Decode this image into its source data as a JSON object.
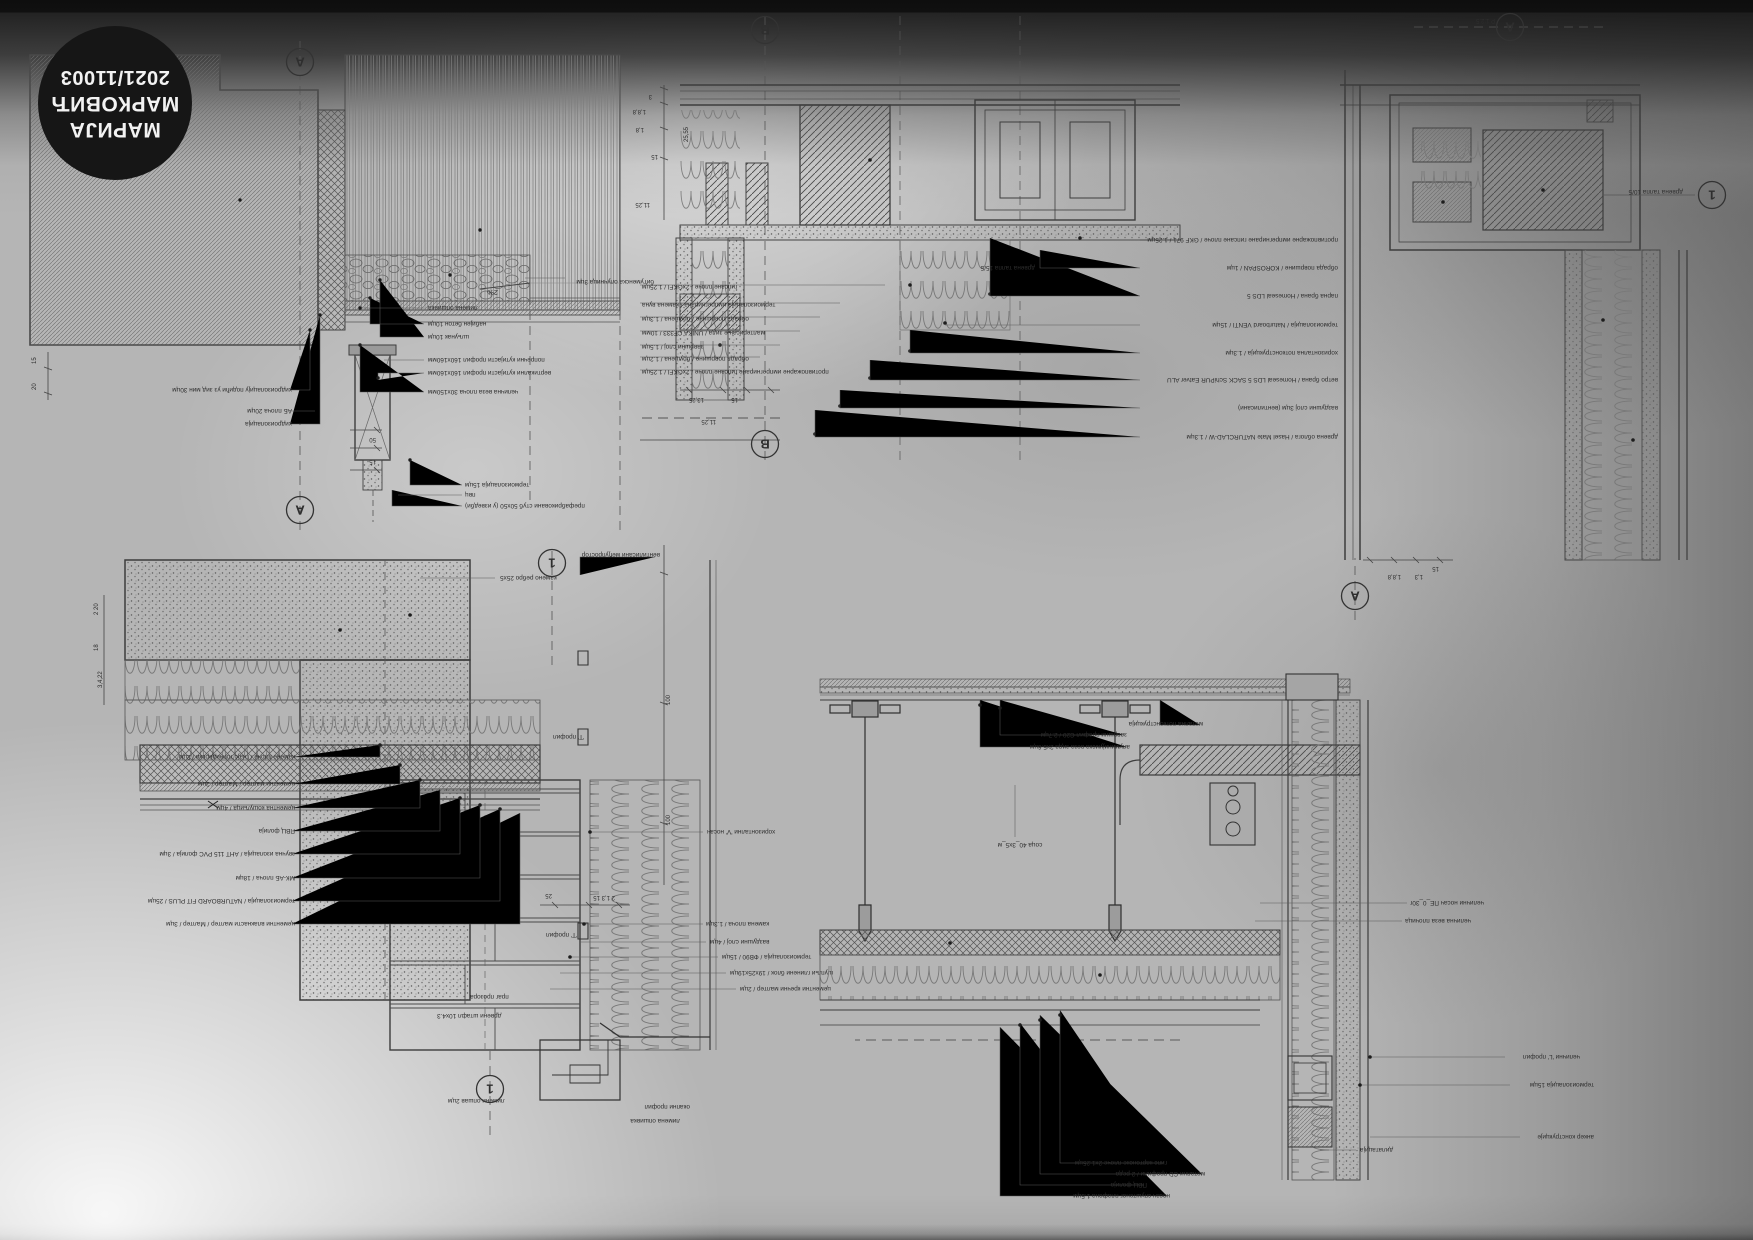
{
  "badge": {
    "line1": "МАРИЈА",
    "line2": "МАРКОВИЋ",
    "line3": "2021/11003"
  },
  "colors": {
    "paper": "#b5b5b5",
    "ink": "#3a3a3a",
    "badge_bg": "#161616",
    "badge_text": "#f2f2f2"
  },
  "details": {
    "terrace_edge": {
      "markers": [
        {
          "x": 360,
          "y": 20,
          "t": "A"
        },
        {
          "x": 360,
          "y": 468,
          "t": "A"
        }
      ],
      "labels": [
        {
          "x": 368,
          "y": 142,
          "t": "хидроизолацију подићи уз зид мин 30цм"
        },
        {
          "x": 368,
          "y": 121,
          "t": "АБ плоча 20цм"
        },
        {
          "x": 368,
          "y": 108,
          "t": "хидроизолација"
        },
        {
          "x": 232,
          "y": 224,
          "t": "лимена опшивка",
          "a": "e"
        },
        {
          "x": 232,
          "y": 208,
          "t": "набијен бетон 10цм",
          "a": "e"
        },
        {
          "x": 232,
          "y": 195,
          "t": "шљунак 10цм",
          "a": "e"
        },
        {
          "x": 232,
          "y": 172,
          "t": "попречни кутијасти профил 160x160мм",
          "a": "e"
        },
        {
          "x": 232,
          "y": 159,
          "t": "вертикални кутијасти профил 160x160мм",
          "a": "e"
        },
        {
          "x": 232,
          "y": 140,
          "t": "челична веза плоча 30x150мм",
          "a": "e"
        },
        {
          "x": 195,
          "y": 47,
          "t": "термоизолација 15цм",
          "a": "e"
        },
        {
          "x": 195,
          "y": 37,
          "t": "пвц",
          "a": "e"
        },
        {
          "x": 195,
          "y": 26,
          "t": "префабриковани стуб 50x50 (у изведби)",
          "a": "e"
        },
        {
          "x": 6,
          "y": 250,
          "t": "битуменска олучница 3цм"
        },
        {
          "x": 162,
          "y": 240,
          "t": "2%",
          "fs": 7.5
        },
        {
          "x": 284,
          "y": 70,
          "t": "15",
          "fs": 6
        },
        {
          "x": 284,
          "y": 92,
          "t": "50",
          "fs": 6
        },
        {
          "x": 624,
          "y": 140,
          "t": "20",
          "r": 90,
          "fs": 6
        },
        {
          "x": 624,
          "y": 166,
          "t": "15",
          "r": 90,
          "fs": 6
        }
      ]
    },
    "window_plan": {
      "markers": [
        {
          "x": 575,
          "y": 430,
          "t": "B"
        },
        {
          "x": 575,
          "y": 16,
          "t": "B"
        }
      ],
      "labels": [
        {
          "x": 2,
          "y": 222,
          "t": "противпожарне импрегниране гипсане плоче / GKF 971 / 1.25цм"
        },
        {
          "x": 2,
          "y": 194,
          "t": "обрада површине / KOROSPAN / 1цм"
        },
        {
          "x": 2,
          "y": 166,
          "t": "парна брана / Homeseal LDS 5"
        },
        {
          "x": 2,
          "y": 137,
          "t": "термоизолација / Naturboard VENTI / 15цм"
        },
        {
          "x": 2,
          "y": 109,
          "t": "хоризонтална потконструкција / 1.3цм"
        },
        {
          "x": 2,
          "y": 82,
          "t": "ветро брана / Homeseal LDS 5 SACK SchiPUR Eatver ALU"
        },
        {
          "x": 2,
          "y": 54,
          "t": "ваздушни слој 3цм (вентилисани)"
        },
        {
          "x": 2,
          "y": 25,
          "t": "дрвена облога / Hasel Mate NATURCLAD-W / 1.3цм"
        },
        {
          "x": 305,
          "y": 194,
          "t": "дрвена талпа 15/5"
        },
        {
          "x": 698,
          "y": 175,
          "t": "гипсане плоче / 2xGKFI / 1.25цм",
          "a": "e"
        },
        {
          "x": 698,
          "y": 157,
          "t": "термоизолација импрегнирана / камена вуна",
          "a": "e"
        },
        {
          "x": 698,
          "y": 143,
          "t": "обрада површине / брушена / 1.3цм",
          "a": "e"
        },
        {
          "x": 698,
          "y": 129,
          "t": "малтерисање зида / UNIKA CF333 / 10мм",
          "a": "e"
        },
        {
          "x": 698,
          "y": 115,
          "t": "завршни слој / 1.5цм",
          "a": "e"
        },
        {
          "x": 698,
          "y": 103,
          "t": "обрада површине / брушена / 1.2цм",
          "a": "e"
        },
        {
          "x": 698,
          "y": 90,
          "t": "противпожарне импрегниране гипсане плоче / 2xGKFI / 1.25цм",
          "a": "e"
        },
        {
          "x": 688,
          "y": 365,
          "t": "3",
          "fs": 6
        },
        {
          "x": 694,
          "y": 350,
          "t": "1,8,8",
          "fs": 6
        },
        {
          "x": 696,
          "y": 332,
          "t": "1,8",
          "fs": 6
        },
        {
          "x": 682,
          "y": 305,
          "t": "15",
          "fs": 6
        },
        {
          "x": 690,
          "y": 257,
          "t": "11,25",
          "fs": 6
        },
        {
          "x": 652,
          "y": 318,
          "t": "25,55",
          "r": 90,
          "fs": 6
        },
        {
          "x": 636,
          "y": 62,
          "t": "13,25",
          "fs": 6
        },
        {
          "x": 602,
          "y": 62,
          "t": "15",
          "fs": 6
        },
        {
          "x": 624,
          "y": 40,
          "t": "11,25",
          "fs": 6
        }
      ]
    },
    "corner_plan": {
      "markers": [
        {
          "x": 243,
          "y": 593,
          "t": "A"
        },
        {
          "x": 398,
          "y": 24,
          "t": "A"
        },
        {
          "x": 41,
          "y": 425,
          "t": "1"
        }
      ],
      "labels": [
        {
          "x": 258,
          "y": 601,
          "t": "Р 1:2.5",
          "fs": 6
        },
        {
          "x": 70,
          "y": 430,
          "t": "дрвена талпа 10/5"
        },
        {
          "x": 352,
          "y": 45,
          "t": "1,8,8",
          "fs": 6
        },
        {
          "x": 330,
          "y": 45,
          "t": "1,3",
          "fs": 6
        },
        {
          "x": 314,
          "y": 53,
          "t": "15",
          "fs": 6
        }
      ]
    },
    "corner_section": {
      "markers": [
        {
          "x": 288,
          "y": 572,
          "t": "1"
        },
        {
          "x": 350,
          "y": 46,
          "t": "1"
        }
      ],
      "labels": [
        {
          "x": 545,
          "y": 380,
          "t": "камене плоче / гнајс топчидерски / 2цм"
        },
        {
          "x": 545,
          "y": 353,
          "t": "цементни малтер / Малтер / 2цм"
        },
        {
          "x": 545,
          "y": 329,
          "t": "цементна кошуљица / 4цм"
        },
        {
          "x": 545,
          "y": 306,
          "t": "ПВЦ фолија"
        },
        {
          "x": 545,
          "y": 283,
          "t": "звучна изолација / АНТ 115 PVC фолија / 3цм"
        },
        {
          "x": 545,
          "y": 259,
          "t": "МК-АБ плоча / 18цм"
        },
        {
          "x": 545,
          "y": 236,
          "t": "термоизолација / NATURBOARD FIT PLUS / 25цм"
        },
        {
          "x": 545,
          "y": 213,
          "t": "цементни влакнасти малтер / Малтер / 3цм"
        },
        {
          "x": 133,
          "y": 305,
          "t": "хоризонтални 'V' носач",
          "a": "e"
        },
        {
          "x": 134,
          "y": 213,
          "t": "камена плоча / 1.3цм",
          "a": "e"
        },
        {
          "x": 130,
          "y": 195,
          "t": "ваздушни слој / 4цм",
          "a": "e"
        },
        {
          "x": 118,
          "y": 180,
          "t": "термоизолација / ФВ90 / 15цм",
          "a": "e"
        },
        {
          "x": 110,
          "y": 164,
          "t": "шупљи глинени блок / 19x25x19цм",
          "a": "e"
        },
        {
          "x": 100,
          "y": 148,
          "t": "цементни кречни малтер / 2цм",
          "a": "e"
        },
        {
          "x": 287,
          "y": 400,
          "t": "'Т' профил",
          "a": "e"
        },
        {
          "x": 294,
          "y": 202,
          "t": "'Т' профил",
          "a": "e"
        },
        {
          "x": 340,
          "y": 559,
          "t": "камено ребро 25x5",
          "a": "e"
        },
        {
          "x": 180,
          "y": 582,
          "t": "вентилисани међупростор"
        },
        {
          "x": 392,
          "y": 36,
          "t": "лимени опшав 2цм",
          "a": "e"
        },
        {
          "x": 150,
          "y": 30,
          "t": "окапни профил"
        },
        {
          "x": 160,
          "y": 16,
          "t": "лимена опшивка"
        },
        {
          "x": 370,
          "y": 140,
          "t": "праг прозора",
          "a": "e"
        },
        {
          "x": 403,
          "y": 121,
          "t": "дрвени штафл 10x4.3",
          "a": "e"
        },
        {
          "x": 170,
          "y": 310,
          "t": "100",
          "r": 90,
          "fs": 6
        },
        {
          "x": 170,
          "y": 430,
          "t": "100",
          "r": 90,
          "fs": 6
        },
        {
          "x": 288,
          "y": 241,
          "t": "25",
          "fs": 6
        },
        {
          "x": 225,
          "y": 239,
          "t": "2 1,3 15",
          "fs": 6
        },
        {
          "x": 742,
          "y": 520,
          "t": "2 20",
          "r": 90,
          "fs": 6
        },
        {
          "x": 742,
          "y": 484,
          "t": "18",
          "r": 90,
          "fs": 6
        },
        {
          "x": 738,
          "y": 447,
          "t": "3,4,22",
          "r": 90,
          "fs": 6
        }
      ]
    },
    "ceiling_section": {
      "markers": [],
      "labels": [
        {
          "x": 473,
          "y": 472,
          "t": "завршни профил C20 / 2.7цм"
        },
        {
          "x": 470,
          "y": 460,
          "t": "алуминијумска веза зида 2x5.6цм"
        },
        {
          "x": 397,
          "y": 483,
          "t": "метална потконструкција"
        },
        {
          "x": 580,
          "y": 362,
          "t": "соца 40_3x5_м",
          "a": "m"
        },
        {
          "x": 433,
          "y": 44,
          "t": "гипс картонске плоче 2x1.25цм"
        },
        {
          "x": 395,
          "y": 33,
          "t": "метални CD профили / 2 реда"
        },
        {
          "x": 453,
          "y": 22,
          "t": "ПВЦ фолија"
        },
        {
          "x": 430,
          "y": 11,
          "t": "носач спуштеног плафона 1.5цм"
        },
        {
          "x": 20,
          "y": 150,
          "t": "челични 'L' профил"
        },
        {
          "x": 6,
          "y": 122,
          "t": "термоизолација 15цм"
        },
        {
          "x": 6,
          "y": 70,
          "t": "анкер конструкције"
        },
        {
          "x": 240,
          "y": 57,
          "t": "дилатација",
          "a": "e"
        },
        {
          "x": 190,
          "y": 304,
          "t": "челични носач ПЕ_0_30г",
          "a": "e"
        },
        {
          "x": 195,
          "y": 286,
          "t": "челична веза плочица",
          "a": "e"
        }
      ]
    }
  }
}
